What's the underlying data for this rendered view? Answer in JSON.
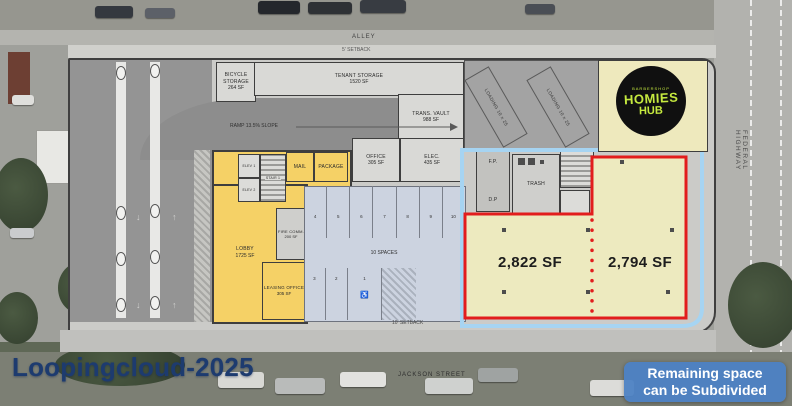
{
  "streets": {
    "alley": "ALLEY",
    "jackson": "JACKSON STREET",
    "federal_highway": "FEDERAL HIGHWAY"
  },
  "setbacks": {
    "top": "5' SETBACK",
    "bottom": "10' SETBACK"
  },
  "ramp_label": "RAMP 13.5% SLOPE",
  "rooms": {
    "bicycle_storage": {
      "name": "BICYCLE STORAGE",
      "area": "264 SF"
    },
    "tenant_storage": {
      "name": "TENANT STORAGE",
      "area": "1520 SF"
    },
    "trans_vault": {
      "name": "TRANS. VAULT",
      "area": "988 SF"
    },
    "office": {
      "name": "OFFICE",
      "area": "305 SF"
    },
    "elec": {
      "name": "ELEC.",
      "area": "435 SF"
    },
    "mail": {
      "name": "MAIL"
    },
    "package": {
      "name": "PACKAGE"
    },
    "elev1": {
      "name": "ELEV 1"
    },
    "elev2": {
      "name": "ELEV 2"
    },
    "stair1": {
      "name": "STAIR 1"
    },
    "fire_comm": {
      "name": "FIRE COMM.",
      "area": "200 SF"
    },
    "lobby": {
      "name": "LOBBY",
      "area": "1725 SF"
    },
    "leasing_office": {
      "name": "LEASING OFFICE",
      "area": "305 SF"
    },
    "fp": {
      "name": "F.P."
    },
    "dp": {
      "name": "D.P"
    },
    "trash": {
      "name": "TRASH"
    }
  },
  "loading_bays": [
    "LOADING 10 x 25",
    "LOADING 10 x 25"
  ],
  "parking": {
    "count_label": "10 SPACES",
    "top_row": [
      "4",
      "5",
      "6",
      "7",
      "8",
      "9",
      "10"
    ],
    "bottom_row": [
      "3",
      "2",
      "1"
    ],
    "accessible_symbol": "♿"
  },
  "retail_spaces": [
    {
      "area": "2,822 SF"
    },
    {
      "area": "2,794 SF"
    }
  ],
  "tenant_logo": {
    "tagline": "BARBERSHOP",
    "line1": "HOMIES",
    "line2": "HUB"
  },
  "callout": {
    "line1": "Remaining space",
    "line2": "can be Subdivided"
  },
  "watermark": "Loopingcloud-2025",
  "colors": {
    "available_outline": "#e21d1d",
    "leased_outline": "#a6d4f2",
    "badge_blue": "#4d82c4",
    "amenity_yellow": "#f5d166",
    "retail_fill": "#edeabf",
    "logo_green": "#c5e93f"
  }
}
